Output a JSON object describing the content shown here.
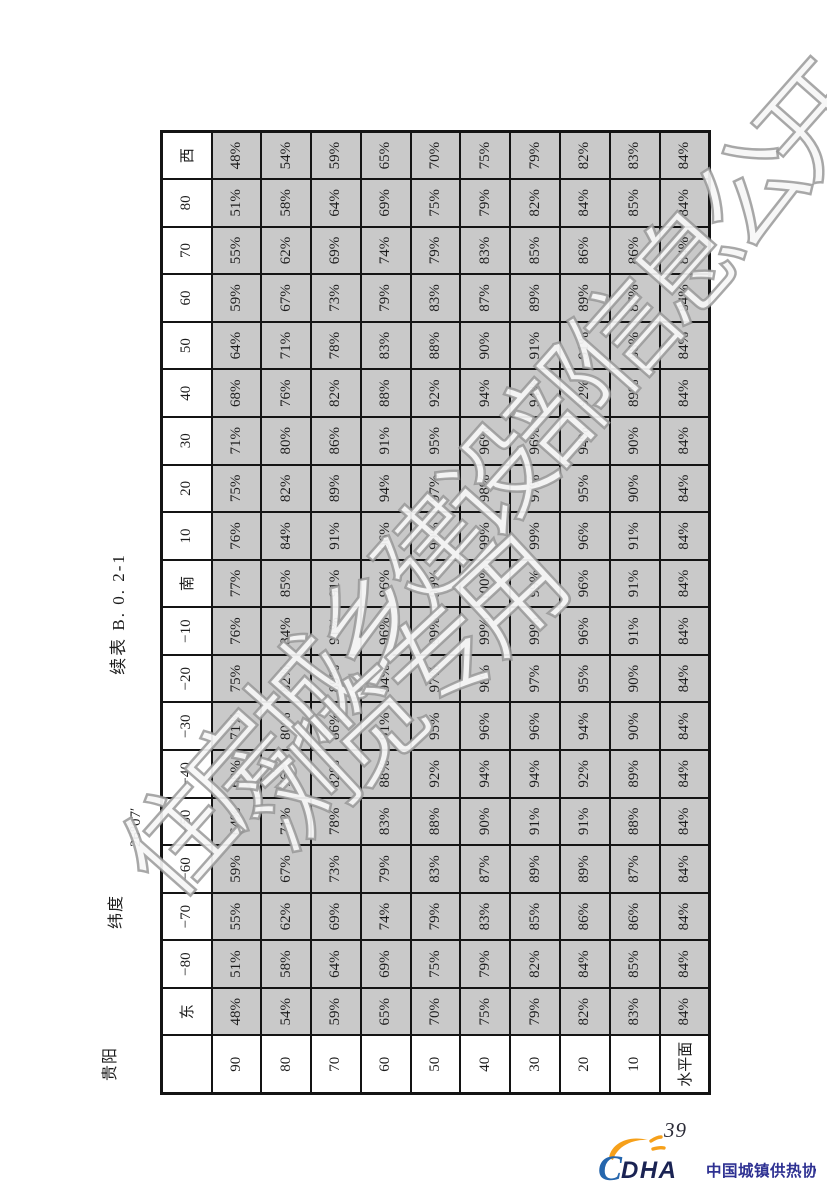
{
  "document": {
    "title": "续表 B. 0. 2-1",
    "city": "贵阳",
    "latitude_label": "纬度",
    "latitude_value": "26°07′"
  },
  "table": {
    "corner_label": "",
    "orientation_headers": [
      "东",
      "−80",
      "−70",
      "−60",
      "−50",
      "−40",
      "−30",
      "−20",
      "−10",
      "南",
      "10",
      "20",
      "30",
      "40",
      "50",
      "60",
      "70",
      "80",
      "西"
    ],
    "tilt_rows": [
      {
        "label": "90",
        "values": [
          "48%",
          "51%",
          "55%",
          "59%",
          "64%",
          "68%",
          "71%",
          "75%",
          "76%",
          "77%",
          "76%",
          "75%",
          "71%",
          "68%",
          "64%",
          "59%",
          "55%",
          "51%",
          "48%"
        ]
      },
      {
        "label": "80",
        "values": [
          "54%",
          "58%",
          "62%",
          "67%",
          "71%",
          "76%",
          "80%",
          "82%",
          "84%",
          "85%",
          "84%",
          "82%",
          "80%",
          "76%",
          "71%",
          "67%",
          "62%",
          "58%",
          "54%"
        ]
      },
      {
        "label": "70",
        "values": [
          "59%",
          "64%",
          "69%",
          "73%",
          "78%",
          "82%",
          "86%",
          "89%",
          "91%",
          "91%",
          "91%",
          "89%",
          "86%",
          "82%",
          "78%",
          "73%",
          "69%",
          "64%",
          "59%"
        ]
      },
      {
        "label": "60",
        "values": [
          "65%",
          "69%",
          "74%",
          "79%",
          "83%",
          "88%",
          "91%",
          "94%",
          "96%",
          "96%",
          "96%",
          "94%",
          "91%",
          "88%",
          "83%",
          "79%",
          "74%",
          "69%",
          "65%"
        ]
      },
      {
        "label": "50",
        "values": [
          "70%",
          "75%",
          "79%",
          "83%",
          "88%",
          "92%",
          "95%",
          "97%",
          "99%",
          "99%",
          "99%",
          "97%",
          "95%",
          "92%",
          "88%",
          "83%",
          "79%",
          "75%",
          "70%"
        ]
      },
      {
        "label": "40",
        "values": [
          "75%",
          "79%",
          "83%",
          "87%",
          "90%",
          "94%",
          "96%",
          "98%",
          "99%",
          "100%",
          "99%",
          "98%",
          "96%",
          "94%",
          "90%",
          "87%",
          "83%",
          "79%",
          "75%"
        ]
      },
      {
        "label": "30",
        "values": [
          "79%",
          "82%",
          "85%",
          "89%",
          "91%",
          "94%",
          "96%",
          "97%",
          "99%",
          "99%",
          "99%",
          "97%",
          "96%",
          "94%",
          "91%",
          "89%",
          "85%",
          "82%",
          "79%"
        ]
      },
      {
        "label": "20",
        "values": [
          "82%",
          "84%",
          "86%",
          "89%",
          "91%",
          "92%",
          "94%",
          "95%",
          "96%",
          "96%",
          "96%",
          "95%",
          "94%",
          "92%",
          "91%",
          "89%",
          "86%",
          "84%",
          "82%"
        ]
      },
      {
        "label": "10",
        "values": [
          "83%",
          "85%",
          "86%",
          "87%",
          "88%",
          "89%",
          "90%",
          "90%",
          "91%",
          "91%",
          "91%",
          "90%",
          "90%",
          "89%",
          "88%",
          "87%",
          "86%",
          "85%",
          "83%"
        ]
      },
      {
        "label": "水平面",
        "values": [
          "84%",
          "84%",
          "84%",
          "84%",
          "84%",
          "84%",
          "84%",
          "84%",
          "84%",
          "84%",
          "84%",
          "84%",
          "84%",
          "84%",
          "84%",
          "84%",
          "84%",
          "84%",
          "84%"
        ]
      }
    ]
  },
  "watermark": {
    "line1": "住房城乡建设部信息公开",
    "line2": "浏览专用"
  },
  "footer": {
    "page_number": "39",
    "logo_c": "C",
    "logo_acronym": "DHA",
    "logo_text": "中国城镇供热协会"
  },
  "colors": {
    "cell_shade": "#c9c9c9",
    "grid_line": "#141414",
    "watermark_grey": "#949494",
    "logo_blue_c": "#2566ad",
    "logo_navy": "#1a2353",
    "logo_orange": "#f6a01a",
    "logo_text_blue": "#2e3192"
  }
}
